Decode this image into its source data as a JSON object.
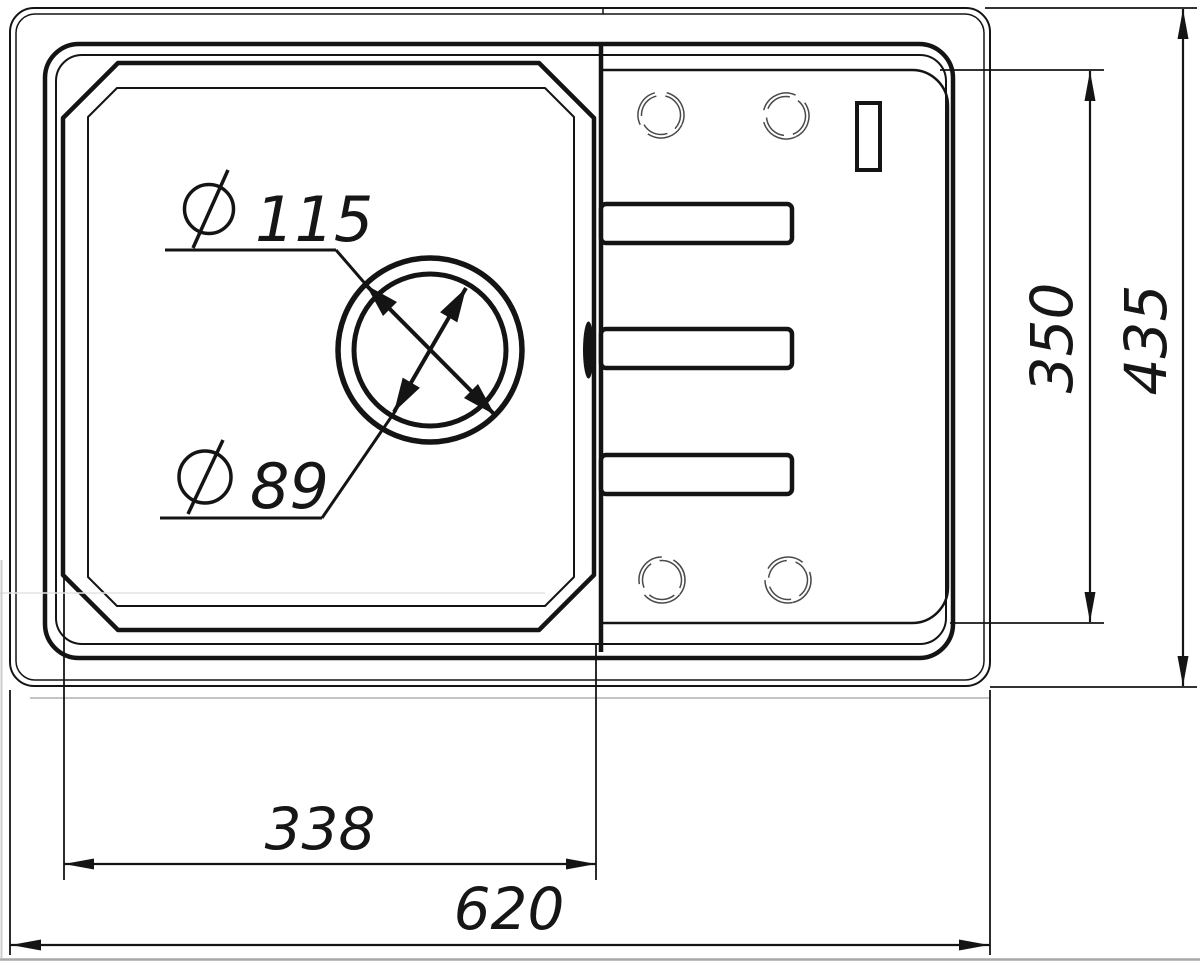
{
  "drawing": {
    "title": "Kitchen sink with drainboard — top view technical drawing",
    "background": "#ffffff",
    "line_color": "#141414",
    "faucet_hole_color": "#4a4a4a",
    "diameter_symbol": "⌀",
    "callouts": {
      "drain_outer": "115",
      "drain_inner": "89"
    },
    "dimensions": {
      "bowl_width": "338",
      "overall_width": "620",
      "drainboard_height": "350",
      "overall_height": "435"
    }
  }
}
